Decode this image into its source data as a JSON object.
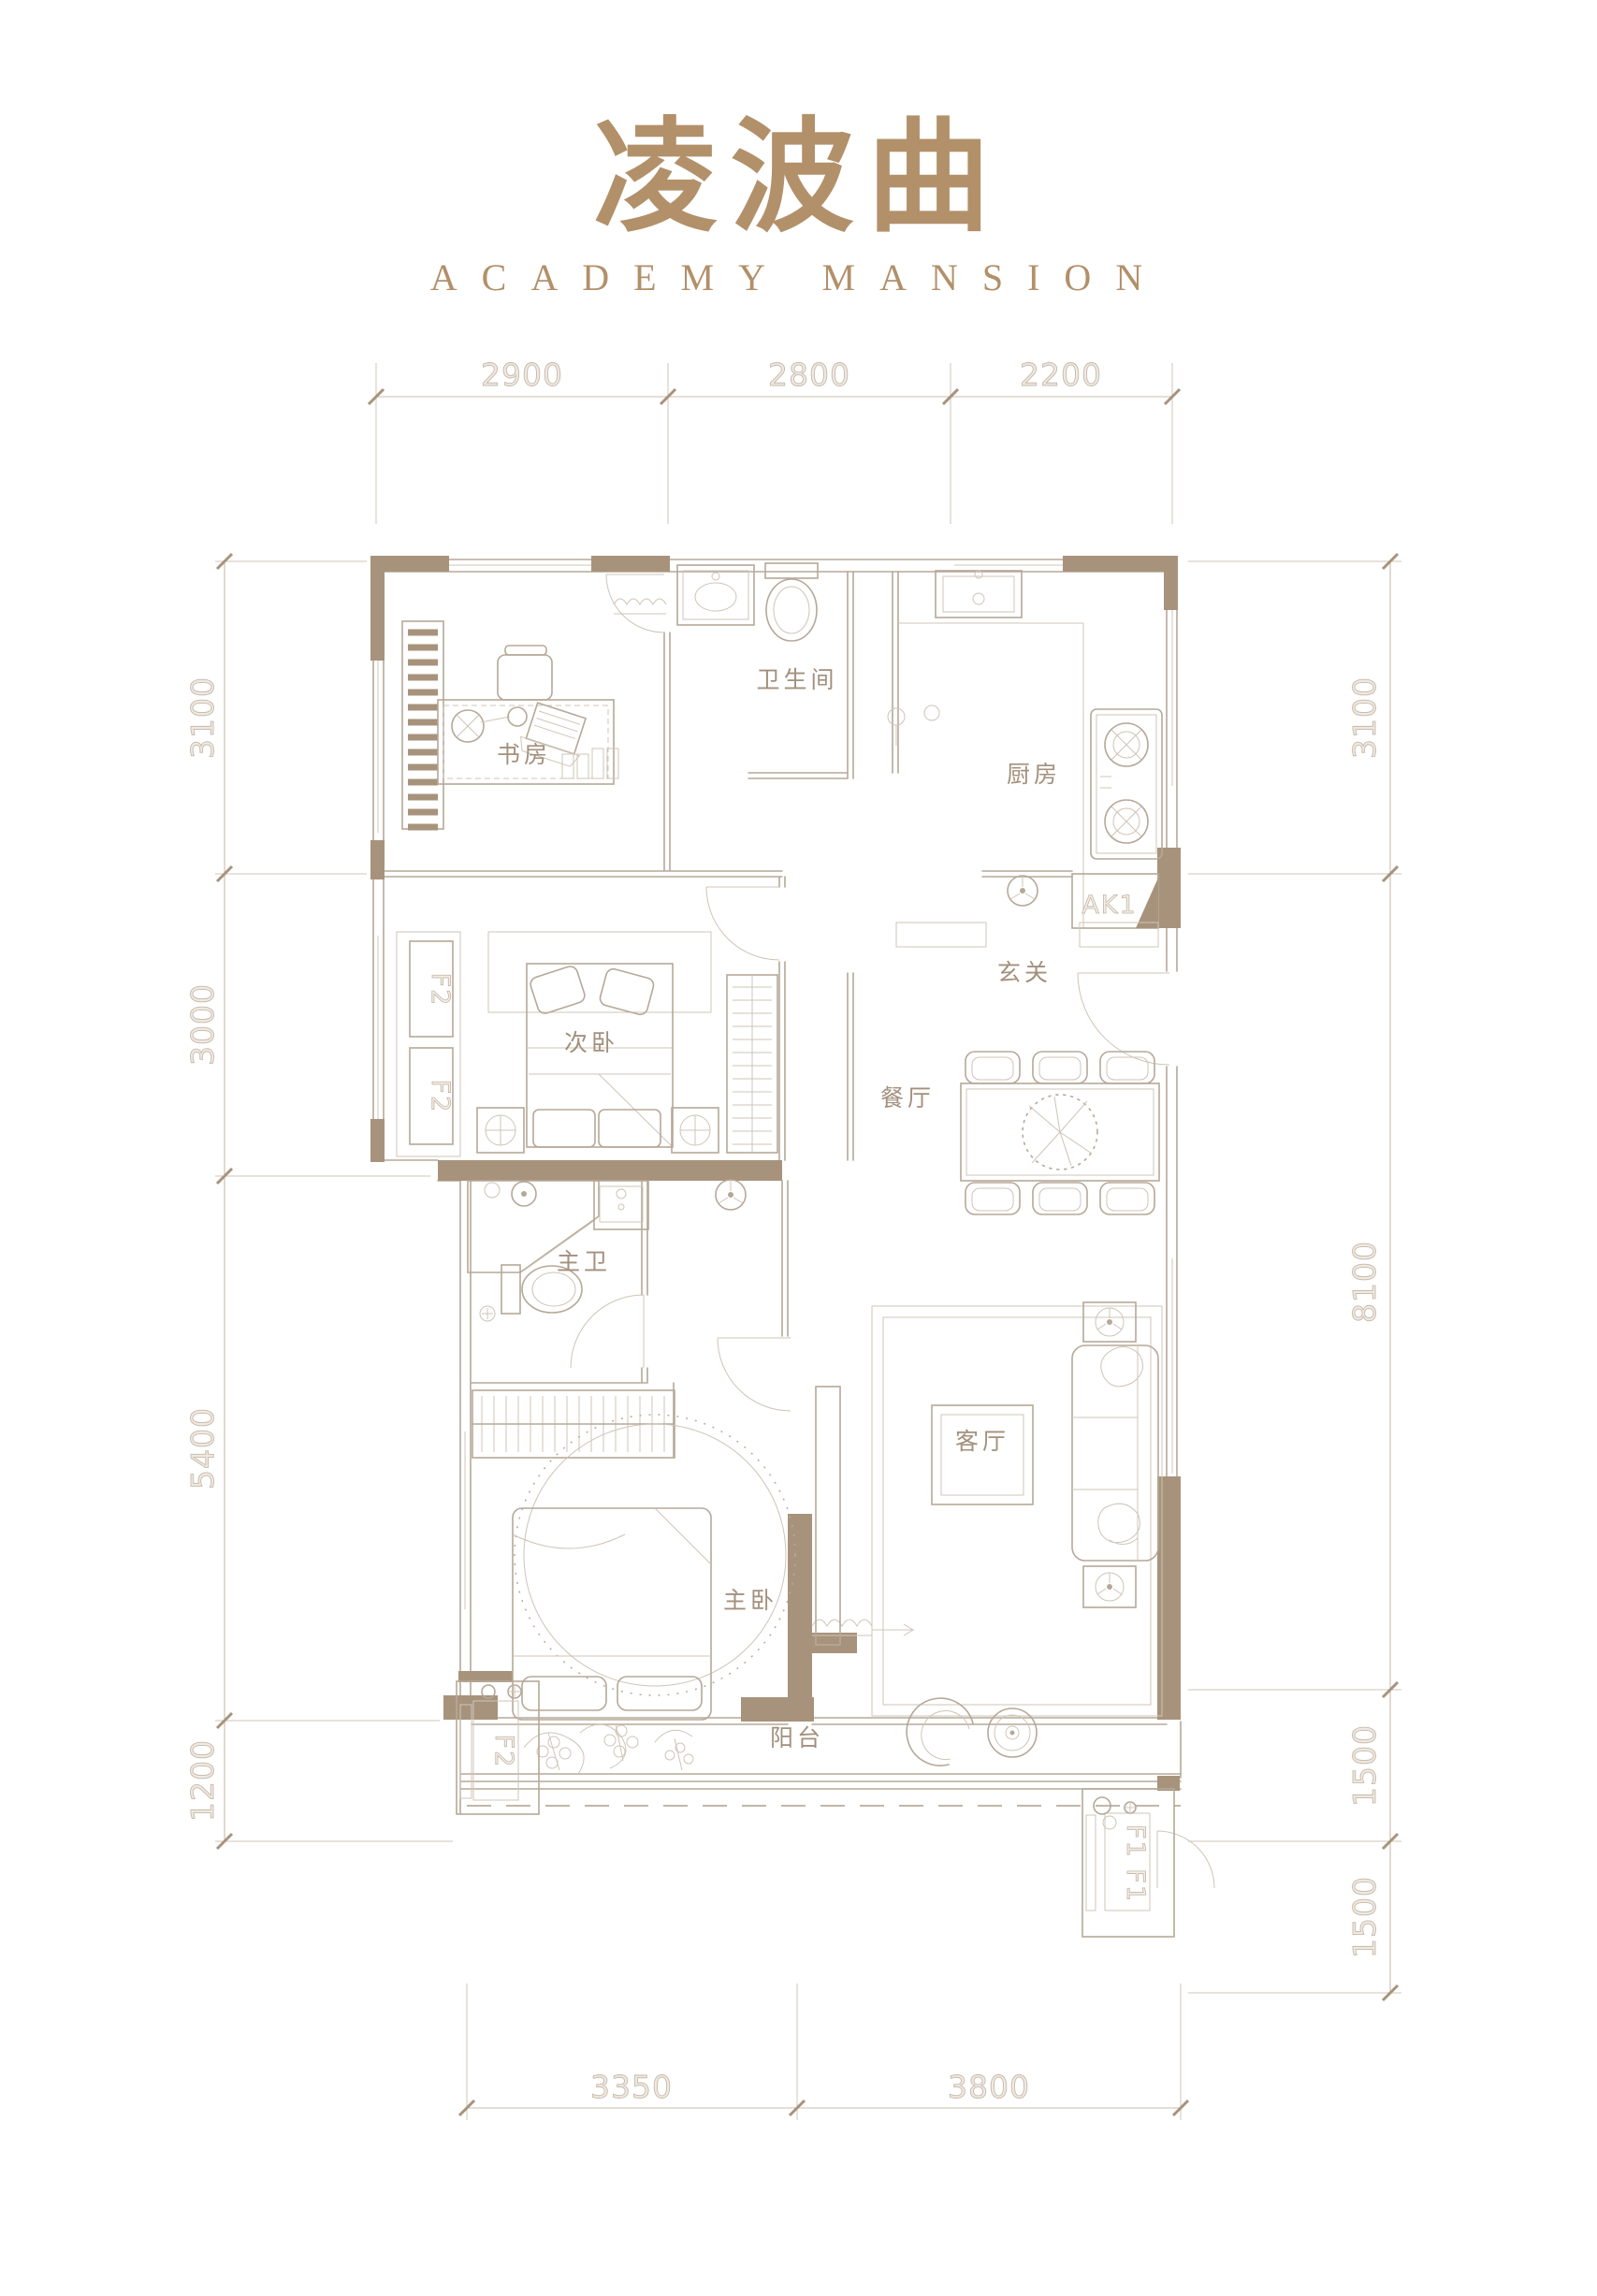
{
  "header": {
    "title": "凌波曲",
    "subtitle": "ACADEMY MANSION"
  },
  "colors": {
    "accent": "#b2906a",
    "wall_fill": "#a7937c",
    "line": "#b6a898",
    "line_light": "#cfc4b7",
    "dim_text_outline": "#c6b9ab",
    "room_text": "#a3907d"
  },
  "rooms": {
    "study": "书房",
    "bathroom": "卫生间",
    "kitchen": "厨房",
    "second_bedroom": "次卧",
    "entry": "玄关",
    "dining": "餐厅",
    "master_bath": "主卫",
    "living": "客厅",
    "master_bedroom": "主卧",
    "balcony": "阳台"
  },
  "fixtures": {
    "f2": "F2",
    "f1": "F1 F1",
    "ak1": "AK1"
  },
  "dimensions": {
    "top": [
      "2900",
      "2800",
      "2200"
    ],
    "left": [
      "3100",
      "3000",
      "5400",
      "1200"
    ],
    "right": [
      "3100",
      "8100",
      "1500",
      "1500"
    ],
    "bottom": [
      "3350",
      "3800"
    ]
  }
}
